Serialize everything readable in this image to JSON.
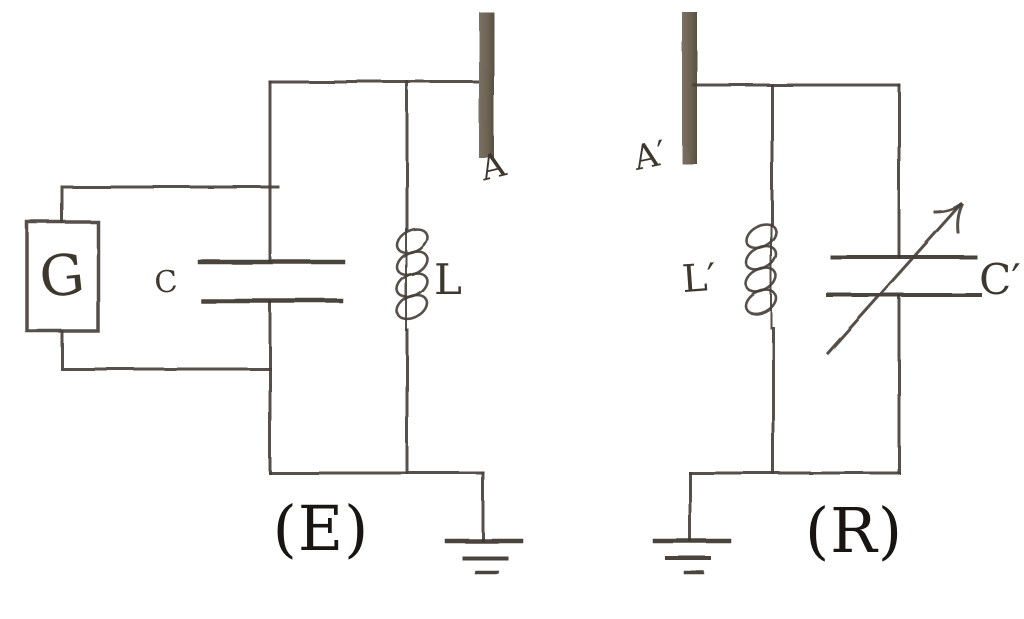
{
  "figure": {
    "background": "#ffffff",
    "ink": "#47413a",
    "plate_ink": "#3a342c",
    "antenna_fill": "#6d6355",
    "label_ink": "#3e372e",
    "caption_ink": "#181512",
    "emitter": {
      "caption": "(E)",
      "generator_label": "G",
      "capacitor_label": "C",
      "inductor_label": "L",
      "antenna_label": "A"
    },
    "receiver": {
      "caption": "(R)",
      "antenna_label": "A′",
      "inductor_label": "L′",
      "capacitor_label": "C′"
    }
  }
}
